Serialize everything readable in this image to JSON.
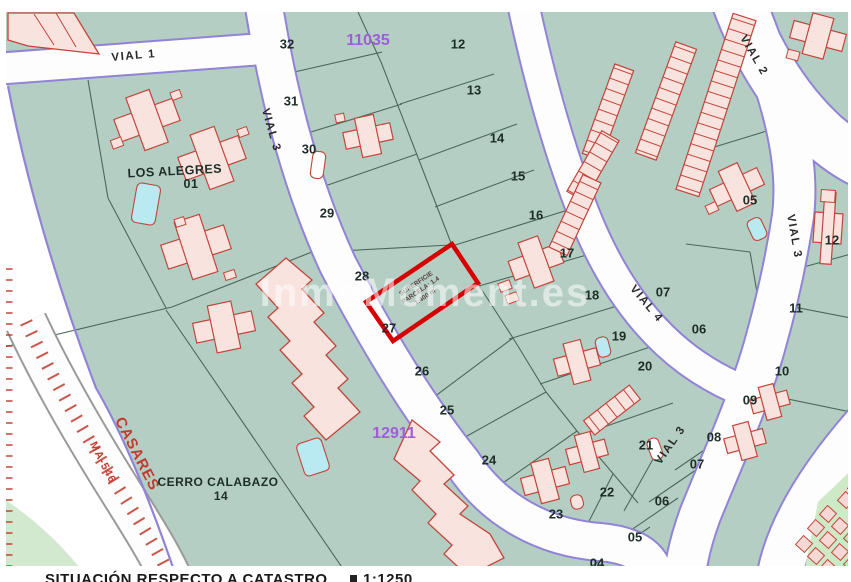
{
  "map": {
    "watermark": {
      "text": "InmoMoment.es"
    },
    "footer": {
      "caption": "SITUACIÓN RESPECTO A CATASTRO",
      "scale": "1:1250"
    },
    "cadastral_refs": [
      {
        "label": "11035",
        "x": 368,
        "y": 40
      },
      {
        "label": "12911",
        "x": 394,
        "y": 433
      }
    ],
    "zones": [
      {
        "name": "LOS ALEGRES",
        "number": "01"
      },
      {
        "name": "CERRO CALABAZO",
        "number": "14"
      }
    ],
    "roads": [
      {
        "label": "VIAL 1",
        "x": 134,
        "y": 59,
        "rot": -5
      },
      {
        "label": "VIAL 3",
        "x": 268,
        "y": 131,
        "rot": 74
      },
      {
        "label": "VIAL 2",
        "x": 751,
        "y": 57,
        "rot": 60
      },
      {
        "label": "VIAL 3",
        "x": 791,
        "y": 237,
        "rot": 80
      },
      {
        "label": "VIAL 4",
        "x": 644,
        "y": 306,
        "rot": 50
      },
      {
        "label": "VIAL 3",
        "x": 673,
        "y": 447,
        "rot": -55
      }
    ],
    "route_texts": [
      {
        "label": "CASARES",
        "x": 133,
        "y": 456,
        "rot": 63,
        "size": 15
      },
      {
        "label": "MA-546",
        "x": 100,
        "y": 464,
        "rot": 63,
        "size": 11
      }
    ],
    "highlight_parcel": {
      "lines": [
        "SUPERFICIE",
        "PARCELA: 1.4",
        "1.400 m"
      ]
    },
    "parcels": [
      {
        "label": "32",
        "x": 287,
        "y": 44
      },
      {
        "label": "31",
        "x": 291,
        "y": 101
      },
      {
        "label": "30",
        "x": 309,
        "y": 149
      },
      {
        "label": "29",
        "x": 327,
        "y": 213
      },
      {
        "label": "28",
        "x": 362,
        "y": 276
      },
      {
        "label": "27",
        "x": 389,
        "y": 328
      },
      {
        "label": "26",
        "x": 422,
        "y": 371
      },
      {
        "label": "25",
        "x": 447,
        "y": 410
      },
      {
        "label": "24",
        "x": 489,
        "y": 460
      },
      {
        "label": "23",
        "x": 556,
        "y": 514
      },
      {
        "label": "22",
        "x": 607,
        "y": 492
      },
      {
        "label": "21",
        "x": 646,
        "y": 445
      },
      {
        "label": "12",
        "x": 458,
        "y": 44
      },
      {
        "label": "13",
        "x": 474,
        "y": 90
      },
      {
        "label": "14",
        "x": 497,
        "y": 138
      },
      {
        "label": "15",
        "x": 518,
        "y": 176
      },
      {
        "label": "16",
        "x": 536,
        "y": 215
      },
      {
        "label": "17",
        "x": 567,
        "y": 253
      },
      {
        "label": "18",
        "x": 592,
        "y": 295
      },
      {
        "label": "19",
        "x": 619,
        "y": 336
      },
      {
        "label": "20",
        "x": 645,
        "y": 366
      },
      {
        "label": "05",
        "x": 750,
        "y": 200
      },
      {
        "label": "12",
        "x": 832,
        "y": 240
      },
      {
        "label": "07",
        "x": 663,
        "y": 292
      },
      {
        "label": "06",
        "x": 699,
        "y": 329
      },
      {
        "label": "11",
        "x": 796,
        "y": 308
      },
      {
        "label": "10",
        "x": 782,
        "y": 371
      },
      {
        "label": "09",
        "x": 750,
        "y": 400
      },
      {
        "label": "08",
        "x": 714,
        "y": 437
      },
      {
        "label": "07",
        "x": 697,
        "y": 464
      },
      {
        "label": "06",
        "x": 662,
        "y": 501
      },
      {
        "label": "05",
        "x": 635,
        "y": 537
      },
      {
        "label": "04",
        "x": 597,
        "y": 563
      }
    ],
    "colors": {
      "map_green": "#b4cec4",
      "light_green": "#d2e9cf",
      "road_edge_purple": "#9183d6",
      "boundary": "#456355",
      "building_fill": "#f8e3df",
      "building_stroke": "#c2453b",
      "pool_blue": "#b9eaf2",
      "highlight_red": "#d60000",
      "ref_purple": "#9e5fd6",
      "route_red": "#c23b2e",
      "label_dark": "#1d2d27"
    }
  }
}
